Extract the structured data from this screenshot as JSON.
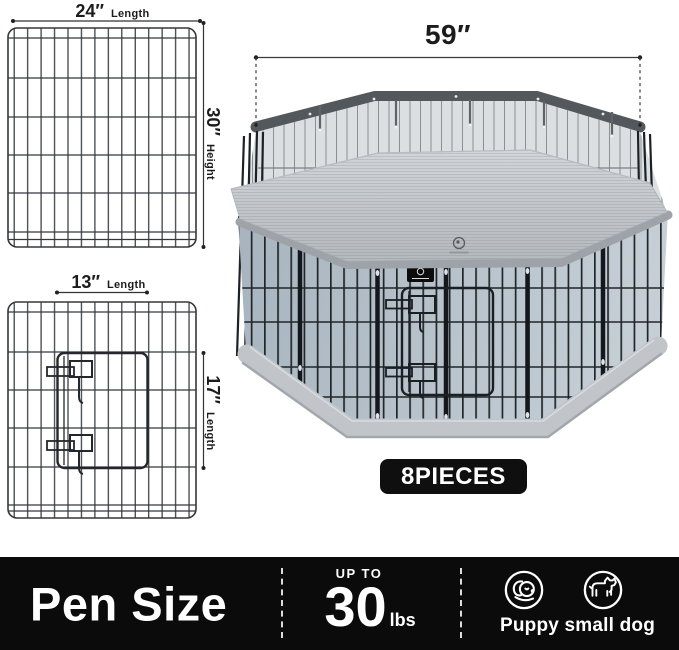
{
  "dimensions_panel_large": {
    "width_value": "24″",
    "width_word": "Length",
    "height_value": "30″",
    "height_word": "Height"
  },
  "dimensions_panel_door": {
    "width_value": "13″",
    "width_word": "Length",
    "height_value": "17″",
    "height_word": "Length"
  },
  "pen_diagram": {
    "diameter_label": "59″",
    "badge": "8PIECES"
  },
  "footer": {
    "title": "Pen Size",
    "weight_prefix": "UP TO",
    "weight_value": "30",
    "weight_unit": "lbs",
    "dogs_label": "Puppy small dog",
    "icons": [
      "puppy-icon",
      "small-dog-icon"
    ]
  },
  "colors": {
    "background": "#ffffff",
    "wire": "#24292e",
    "mesh_band": "#53585d",
    "mesh_fill": "#dcdfe2",
    "cover": "#c3c8cc",
    "floor_left": "#a7b4bf",
    "floor_right": "#c6cfd6",
    "rim": "#c1c5c9",
    "footer_bg": "#0b0b0b",
    "badge_bg": "#0f0f0f",
    "text": "#1c1c1c"
  }
}
